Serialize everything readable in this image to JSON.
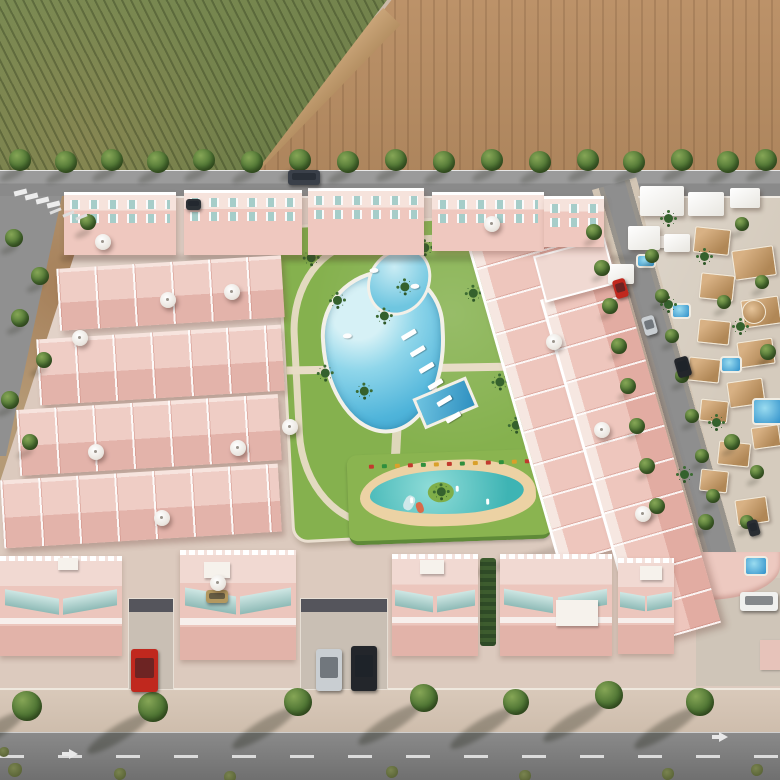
{
  "meta": {
    "description": "Aerial 3D render of a new-build residential complex of salmon-pink townhouses and apartment blocks arranged around a landscaped communal garden with a freeform swimming pool, a rectangular lap pool and a children's splash pool; bordered on the north by a tree-lined road with an orchard field and a plowed brown field beyond, on the east by an existing district of white villas with tan roofs and private pools, and on the south by a public road with sidewalk trees and parked cars.",
    "type": "architectural-aerial-render",
    "text_content": "none"
  },
  "palette": {
    "orchard_green": "#72814C",
    "plowed_brown": "#B28A61",
    "field_margin_tan": "#C9A478",
    "asphalt": "#8A8A8A",
    "dirt": "#B59A76",
    "complex_ground": "#DCCABE",
    "building_pink": "#EEC5BC",
    "building_pink_shadow": "#D99E94",
    "trim_white": "#FFFFFF",
    "lawn_green": "#85B14E",
    "hedge_green": "#5F8A38",
    "pool_blue": "#6FC6E0",
    "lap_pool_blue": "#3F9FCB",
    "kids_pool_teal": "#58C6C6",
    "sand": "#ECD2A4",
    "glass_teal": "#9FC9C6",
    "villa_roof_tan": "#C29A6C",
    "tree_green": "#4E7433",
    "sidewalk": "#D3C2B2",
    "car_red": "#C0281E",
    "car_silver": "#C9CED2",
    "car_dark": "#23262B",
    "car_white": "#F0F0EE"
  },
  "scene": {
    "shadow_patches": [
      [
        60,
        255,
        586,
        7,
        0,
        0.14
      ],
      [
        470,
        556,
        100,
        9,
        -16,
        0.13
      ]
    ],
    "buildings": {
      "strips": [
        [
          468,
          248,
          104,
          330
        ],
        [
          540,
          300,
          82,
          360
        ]
      ],
      "terrace_block": [
        538,
        246,
        70,
        44
      ],
      "apartments": [
        [
          64,
          192,
          112,
          60
        ],
        [
          184,
          190,
          118,
          62
        ],
        [
          308,
          188,
          116,
          64
        ],
        [
          432,
          192,
          112,
          56
        ],
        [
          544,
          196,
          60,
          48
        ]
      ],
      "townhouse_rows": [
        [
          58,
          262,
          225,
          62
        ],
        [
          38,
          332,
          245,
          66
        ],
        [
          18,
          402,
          262,
          66
        ],
        [
          2,
          472,
          278,
          68
        ]
      ],
      "townhouse_fronts": [
        [
          0,
          556,
          122,
          100
        ],
        [
          180,
          550,
          116,
          110
        ],
        [
          392,
          554,
          86,
          102
        ],
        [
          500,
          554,
          112,
          102
        ],
        [
          618,
          558,
          56,
          96
        ]
      ],
      "driveways": [
        [
          128,
          598,
          46,
          92
        ],
        [
          300,
          598,
          88,
          92
        ]
      ],
      "hedge_alley": [
        480,
        558,
        16,
        88
      ],
      "roof_boxes": [
        [
          204,
          562,
          26,
          16
        ],
        [
          420,
          560,
          24,
          14
        ],
        [
          556,
          600,
          42,
          26
        ],
        [
          640,
          566,
          22,
          14
        ],
        [
          58,
          558,
          20,
          12
        ],
        [
          658,
          236,
          18,
          12
        ]
      ]
    },
    "villas": {
      "white_blocks": [
        [
          640,
          186,
          44,
          30
        ],
        [
          688,
          192,
          36,
          24
        ],
        [
          730,
          188,
          30,
          20
        ],
        [
          628,
          226,
          32,
          24
        ],
        [
          664,
          234,
          26,
          18
        ],
        [
          608,
          264,
          26,
          20
        ]
      ],
      "roof_blocks": [
        [
          694,
          228,
          34,
          24
        ],
        [
          733,
          248,
          40,
          28
        ],
        [
          700,
          274,
          32,
          24
        ],
        [
          742,
          298,
          36,
          26
        ],
        [
          698,
          320,
          30,
          22
        ],
        [
          738,
          340,
          34,
          24
        ],
        [
          688,
          358,
          30,
          22
        ],
        [
          728,
          380,
          34,
          24
        ],
        [
          700,
          400,
          26,
          20
        ],
        [
          752,
          426,
          26,
          20
        ],
        [
          718,
          442,
          30,
          22
        ],
        [
          736,
          498,
          30,
          24
        ],
        [
          700,
          470,
          26,
          20
        ]
      ],
      "round_tower": [
        742,
        300,
        22
      ],
      "pools": [
        [
          636,
          254,
          16,
          10
        ],
        [
          671,
          303,
          16,
          12
        ],
        [
          720,
          356,
          18,
          13
        ],
        [
          752,
          398,
          27,
          23
        ],
        [
          744,
          556,
          20,
          16
        ]
      ],
      "palms": [
        [
          664,
          214
        ],
        [
          700,
          252
        ],
        [
          664,
          300
        ],
        [
          736,
          322
        ],
        [
          712,
          418
        ],
        [
          680,
          470
        ]
      ]
    },
    "park": {
      "palms": [
        [
          50,
          70
        ],
        [
          96,
          88
        ],
        [
          72,
          162
        ],
        [
          34,
          142
        ],
        [
          118,
          60
        ],
        [
          80,
          242
        ],
        [
          26,
          26
        ],
        [
          140,
          22
        ],
        [
          186,
          70
        ],
        [
          208,
          160
        ],
        [
          222,
          204
        ],
        [
          60,
          286
        ],
        [
          150,
          250
        ]
      ],
      "loungers": [
        [
          116,
          110
        ],
        [
          124,
          127
        ],
        [
          132,
          144
        ],
        [
          140,
          161
        ],
        [
          148,
          178
        ],
        [
          156,
          195
        ]
      ],
      "sculptures": [
        [
          88,
          44
        ],
        [
          128,
          62
        ],
        [
          58,
          108
        ]
      ]
    },
    "kids": {
      "fence_colors": [
        "#C23A2E",
        "#2F8F3D",
        "#D9A02B"
      ],
      "figures": [
        [
          40,
          26
        ],
        [
          86,
          16
        ],
        [
          116,
          30
        ]
      ]
    },
    "trees": [
      {
        "name": "tree-road-top",
        "shadow": [
          -8,
          10,
          26,
          9,
          -25,
          0.22
        ],
        "items": [
          [
            20,
            160,
            11
          ],
          [
            66,
            162,
            11
          ],
          [
            112,
            160,
            11
          ],
          [
            158,
            162,
            11
          ],
          [
            204,
            160,
            11
          ],
          [
            252,
            162,
            11
          ],
          [
            300,
            160,
            11
          ],
          [
            348,
            162,
            11
          ],
          [
            396,
            160,
            11
          ],
          [
            444,
            162,
            11
          ],
          [
            492,
            160,
            11
          ],
          [
            540,
            162,
            11
          ],
          [
            588,
            160,
            11
          ],
          [
            634,
            162,
            11
          ],
          [
            682,
            160,
            11
          ],
          [
            728,
            162,
            11
          ],
          [
            766,
            160,
            11
          ]
        ]
      },
      {
        "name": "tree-left-road",
        "shadow": [
          -5,
          8,
          18,
          7,
          -25,
          0.2
        ],
        "items": [
          [
            14,
            238,
            9
          ],
          [
            40,
            276,
            9
          ],
          [
            20,
            318,
            9
          ],
          [
            44,
            360,
            8
          ],
          [
            10,
            400,
            9
          ],
          [
            30,
            442,
            8
          ],
          [
            88,
            222,
            8
          ]
        ]
      },
      {
        "name": "tree-street-west",
        "shadow": [
          -4,
          7,
          14,
          6,
          -25,
          0.2
        ],
        "items": [
          [
            594,
            232,
            8
          ],
          [
            602,
            268,
            8
          ],
          [
            610,
            306,
            8
          ],
          [
            619,
            346,
            8
          ],
          [
            628,
            386,
            8
          ],
          [
            637,
            426,
            8
          ],
          [
            647,
            466,
            8
          ],
          [
            657,
            506,
            8
          ]
        ]
      },
      {
        "name": "tree-street-east",
        "shadow": [
          -4,
          7,
          14,
          6,
          -25,
          0.2
        ],
        "items": [
          [
            652,
            256,
            7
          ],
          [
            662,
            296,
            7
          ],
          [
            672,
            336,
            7
          ],
          [
            682,
            376,
            7
          ],
          [
            692,
            416,
            7
          ],
          [
            702,
            456,
            7
          ],
          [
            713,
            496,
            7
          ]
        ]
      },
      {
        "name": "tree-villas",
        "shadow": [
          -4,
          7,
          14,
          6,
          -25,
          0.2
        ],
        "items": [
          [
            742,
            224,
            7
          ],
          [
            762,
            282,
            7
          ],
          [
            724,
            302,
            7
          ],
          [
            768,
            352,
            8
          ],
          [
            732,
            442,
            8
          ],
          [
            757,
            472,
            7
          ],
          [
            706,
            522,
            8
          ],
          [
            747,
            522,
            7
          ]
        ]
      },
      {
        "name": "tree-sidewalk",
        "shadow": [
          -34,
          18,
          74,
          16,
          -32,
          0.3
        ],
        "items": [
          [
            27,
            706,
            15
          ],
          [
            153,
            707,
            15
          ],
          [
            298,
            702,
            14
          ],
          [
            424,
            698,
            14
          ],
          [
            516,
            702,
            13
          ],
          [
            609,
            695,
            14
          ],
          [
            700,
            702,
            14
          ]
        ]
      }
    ],
    "bushes": [
      [
        15,
        770,
        7
      ],
      [
        120,
        774,
        6
      ],
      [
        230,
        777,
        6
      ],
      [
        392,
        772,
        6
      ],
      [
        525,
        776,
        6
      ],
      [
        668,
        774,
        6
      ],
      [
        757,
        770,
        6
      ],
      [
        4,
        752,
        5
      ]
    ],
    "cars": [
      {
        "name": "van-dark-top-road",
        "x": 288,
        "y": 170,
        "w": 32,
        "h": 15,
        "rot": 0,
        "hex": "#3A4049"
      },
      {
        "name": "car-dark-top-blocks",
        "x": 186,
        "y": 199,
        "w": 15,
        "h": 11,
        "rot": 0,
        "hex": "#2C3136"
      },
      {
        "name": "car-red-right-street",
        "x": 614,
        "y": 279,
        "w": 13,
        "h": 19,
        "rot": -16,
        "hex": "#C0281E"
      },
      {
        "name": "car-silver-right-street",
        "x": 643,
        "y": 316,
        "w": 13,
        "h": 19,
        "rot": -16,
        "hex": "#C9CED2"
      },
      {
        "name": "car-dark-right-street",
        "x": 676,
        "y": 357,
        "w": 14,
        "h": 20,
        "rot": -16,
        "hex": "#23262B"
      },
      {
        "name": "car-dark-street-top",
        "x": 748,
        "y": 520,
        "w": 11,
        "h": 16,
        "rot": -16,
        "hex": "#2A2E33"
      },
      {
        "name": "car-red-driveway",
        "x": 131,
        "y": 649,
        "w": 27,
        "h": 43,
        "rot": 0,
        "hex": "#C0281E"
      },
      {
        "name": "car-silver-driveway",
        "x": 316,
        "y": 649,
        "w": 26,
        "h": 42,
        "rot": 0,
        "hex": "#C9CED2"
      },
      {
        "name": "car-dark-driveway",
        "x": 351,
        "y": 646,
        "w": 26,
        "h": 45,
        "rot": 0,
        "hex": "#23262B"
      },
      {
        "name": "car-white-villa-driveway",
        "x": 740,
        "y": 592,
        "w": 38,
        "h": 19,
        "rot": 0,
        "hex": "#F0F0EE"
      },
      {
        "name": "car-beige-court",
        "x": 206,
        "y": 590,
        "w": 22,
        "h": 13,
        "rot": 0,
        "hex": "#B3985F"
      }
    ],
    "umbrellas": [
      [
        103,
        242
      ],
      [
        168,
        300
      ],
      [
        232,
        292
      ],
      [
        80,
        338
      ],
      [
        96,
        452
      ],
      [
        238,
        448
      ],
      [
        162,
        518
      ],
      [
        492,
        224
      ],
      [
        554,
        342
      ],
      [
        602,
        430
      ],
      [
        643,
        514
      ],
      [
        218,
        583
      ],
      [
        290,
        427
      ]
    ],
    "marks": {
      "crosswalk": [
        [
          14,
          190
        ],
        [
          25,
          194
        ],
        [
          36,
          198
        ],
        [
          47,
          202
        ]
      ],
      "stalls": [
        [
          54,
          205
        ],
        [
          67,
          208
        ],
        [
          80,
          211
        ]
      ],
      "arrows": [
        [
          62,
          752
        ],
        [
          712,
          735
        ]
      ]
    }
  }
}
